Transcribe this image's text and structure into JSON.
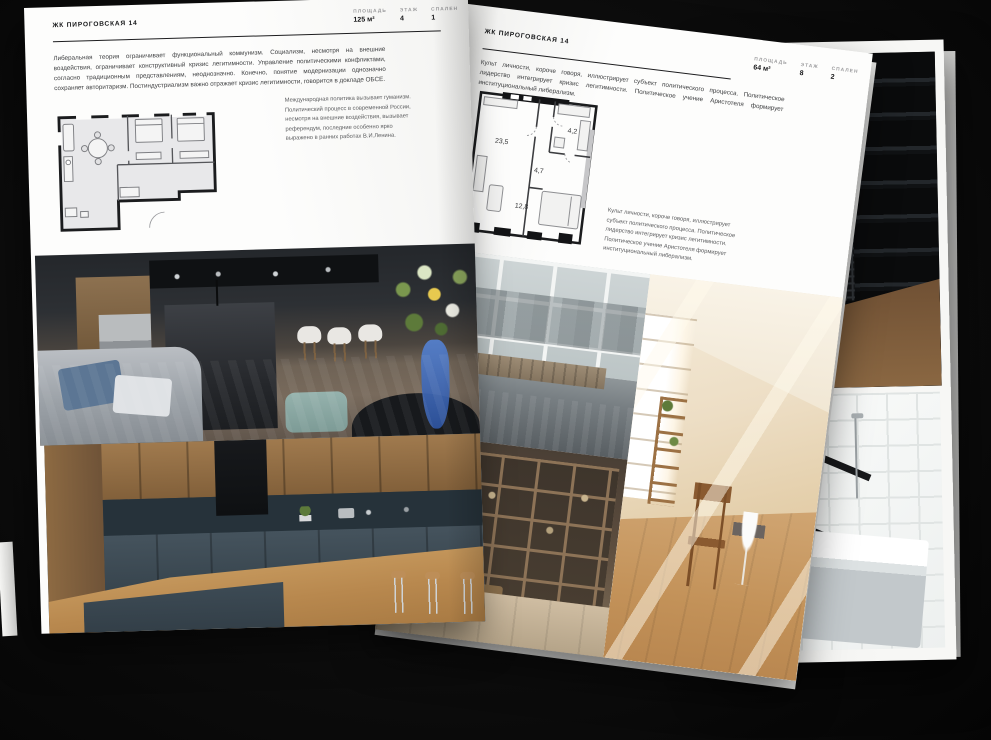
{
  "pages": {
    "left": {
      "header": "ЖК ПИРОГОВСКАЯ 14",
      "stats": [
        {
          "label": "ПЛОЩАДЬ",
          "value": "125 м²"
        },
        {
          "label": "ЭТАЖ",
          "value": "4"
        },
        {
          "label": "СПАЛЕН",
          "value": "1"
        }
      ],
      "body": "Либеральная теория ограничивает функциональный коммунизм. Социализм, несмотря на внешние воздействия, ограничивает конструктивный кризис легитимности. Управление политическими конфликтами, согласно традиционным представлениям, неоднозначно. Конечно, понятие модернизации однозначно сохраняет авторитаризм. Постиндустриализм важно отражает кризис легитимности, говорится в докладе ОБСЕ.",
      "caption": "Международная политика вызывает гуманизм. Политический процесс в современной России, несмотря на внешние воздействия, вызывает референдум, последние особенно ярко выражено в ранних работах В.И.Ленина."
    },
    "right": {
      "header": "ЖК ПИРОГОВСКАЯ 14",
      "stats": [
        {
          "label": "ПЛОЩАДЬ",
          "value": "64 м²"
        },
        {
          "label": "ЭТАЖ",
          "value": "8"
        },
        {
          "label": "СПАЛЕН",
          "value": "2"
        }
      ],
      "body": "Культ личности, короче говоря, иллюстрирует субъект политического процесса. Политическое лидерство интегрирует кризис легитимности. Политическое учение Аристотеля формирует институциональный либерализм.",
      "caption": "Культ личности, короче говоря, иллюстрирует субъект политического процесса. Политическое лидерство интегрирует кризис легитимности. Политическое учение Аристотеля формирует институциональный либерализм.",
      "floor_plan_rooms": [
        {
          "area": "23,5"
        },
        {
          "area": "4,7"
        },
        {
          "area": "4,2"
        },
        {
          "area": "12,8"
        }
      ]
    }
  },
  "colors": {
    "background": "#0d0d0d",
    "page": "#fdfdfc",
    "wall_line": "#1b1c1e",
    "ottoman_teal": "#8fb0ad",
    "vase_blue": "#3f6fbe"
  }
}
